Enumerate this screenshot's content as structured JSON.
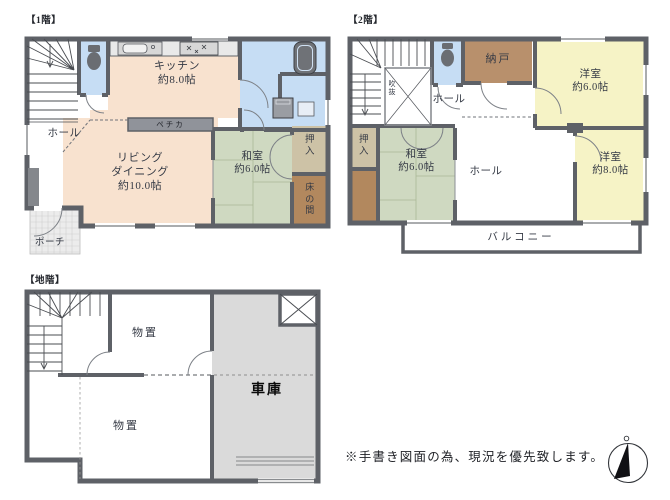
{
  "colors": {
    "wall": "#5e6167",
    "ldk_peach": "#f8e2cf",
    "tatami_green": "#cfd9c1",
    "western_yellow": "#f6f3c6",
    "water_blue": "#c6ddf4",
    "closet_tan": "#cdc2a6",
    "alcove_brown": "#b2885e",
    "storage_brown": "#b8906c",
    "garage_gray": "#dadada",
    "pechka_gray": "#90939a",
    "label_text": "#353a45"
  },
  "floor1": {
    "title": "【1階】",
    "rooms": {
      "hall": "ホール",
      "kitchen": "キッチン\n約8.0帖",
      "pechka": "ペチカ",
      "living_dining": "リビング\nダイニング\n約10.0帖",
      "washitsu": "和室\n約6.0帖",
      "oshiire": "押\n入",
      "tokonoma": "床\nの\n間",
      "porch": "ポーチ"
    }
  },
  "floor2": {
    "title": "【2階】",
    "rooms": {
      "nando": "納戸",
      "youshitsu6": "洋室\n約6.0帖",
      "fukinuke": "吹\n抜",
      "hall_upper": "ホール",
      "oshiire": "押\n入",
      "washitsu": "和室\n約6.0帖",
      "hall_lower": "ホール",
      "youshitsu8": "洋室\n約8.0帖",
      "balcony": "バルコニー"
    }
  },
  "basement": {
    "title": "【地階】",
    "rooms": {
      "storage_upper": "物置",
      "storage_lower": "物置",
      "garage": "車庫"
    }
  },
  "footnote": "※手書き図面の為、現況を優先致します。",
  "icons": {
    "compass": "compass-north-icon",
    "toilet": "toilet-icon",
    "bathtub": "bathtub-icon",
    "sink": "kitchen-sink-icon",
    "stove": "stove-icon",
    "washer": "washing-machine-icon",
    "stairs": "stairs-icon"
  }
}
